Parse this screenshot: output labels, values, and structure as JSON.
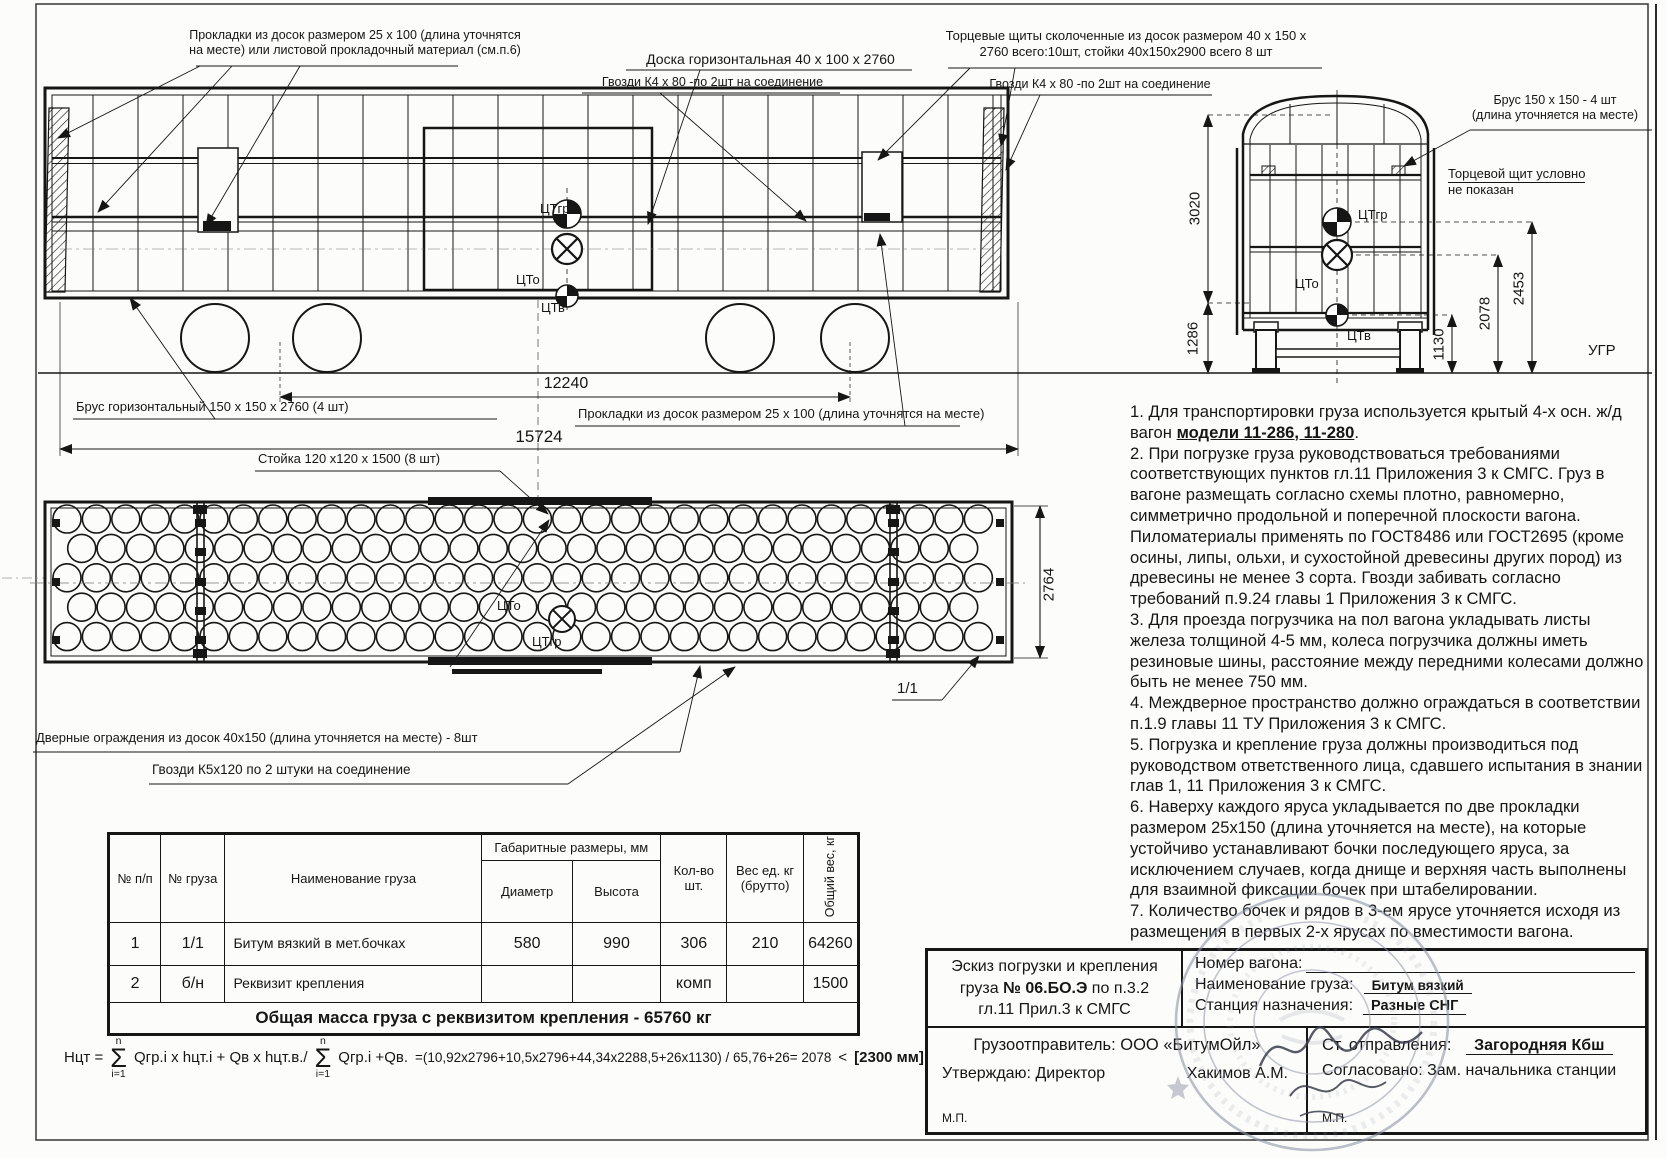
{
  "colors": {
    "paper": "#fcfcfb",
    "ink": "#161616",
    "stamp": "#8d94a6"
  },
  "callouts": {
    "gaskets_top": "Прокладки из досок размером 25 x 100 (длина уточнятся на месте) или листовой прокладочный материал (см.п.6)",
    "board_horizontal": "Доска горизонтальная 40 x 100 x 2760",
    "nails_k4": "Гвозди К4 х 80 -по 2шт на соединение",
    "end_shields": "Торцевые щиты сколоченные из досок размером 40 x 150 x 2760 всего:10шт, стойки 40х150х2900 всего 8 шт",
    "brus_horizontal": "Брус горизонтальный 150 x 150 x 2760 (4 шт)",
    "gaskets_bottom": "Прокладки из досок размером 25 x 100 (длина уточнятся на месте)",
    "stoika": "Стойка 120 х120 х 1500 (8 шт)",
    "door_guards": "Дверные ограждения из досок 40х150 (длина уточняется на месте) - 8шт",
    "nails_k5": "Гвозди К5х120 по 2 штуки на соединение",
    "brus_end_l1": "Брус 150 x 150 - 4 шт",
    "brus_end_l2": "(длина уточняется на месте)",
    "end_shield_note_l1": "Торцевой щит условно",
    "end_shield_note_l2": "не показан",
    "item_mark": "1/1"
  },
  "dimensions": {
    "wheel_base": "12240",
    "overall_length": "15724",
    "inner_height": "3020",
    "floor_height": "1286",
    "cg_wagon_height": "1130",
    "cg_combined_height": "2078",
    "cg_cargo_height": "2453",
    "inner_width": "2764",
    "rail_level": "УГР"
  },
  "cg": {
    "cargo": "ЦТгр",
    "combined": "ЦТо",
    "wagon": "ЦТв"
  },
  "notes": {
    "n1_pre": "1. Для транспортировки груза используется крытый 4-х осн. ж/д вагон ",
    "n1_model": "модели 11-286, 11-280",
    "n1_post": ".",
    "n2": "2. При погрузке груза руководствоваться требованиями соответствующих пунктов гл.11 Приложения 3 к СМГС.  Груз в вагоне размещать согласно схемы плотно, равномерно, симметрично продольной и поперечной плоскости вагона. Пиломатериалы применять по ГОСТ8486 или ГОСТ2695 (кроме осины, липы, ольхи, и сухостойной древесины других пород) из древесины не менее 3 сорта. Гвозди забивать согласно требований п.9.24  главы 1 Приложения 3 к СМГС.",
    "n3": "3. Для проезда погрузчика на пол вагона укладывать листы железа толщиной 4-5 мм, колеса погрузчика должны иметь резиновые шины, расстояние между передними колесами должно быть не менее 750  мм.",
    "n4": "4. Междверное пространство должно ограждаться в соответствии п.1.9 главы 11 ТУ Приложения 3 к СМГС.",
    "n5": "5. Погрузка и крепление груза должны производиться под руководством ответственного лица, сдавшего испытания в знании глав 1, 11 Приложения 3 к СМГС.",
    "n6": "6. Наверху каждого яруса укладывается по две прокладки размером 25х150 (длина уточняется на месте), на которые устойчиво устанавливают бочки последующего яруса, за исключением случаев, когда днище и верхняя часть выполнены для взаимной фиксации бочек при штабелировании.",
    "n7": "7. Количество бочек и рядов в 3-ем ярусе уточняется исходя из размещения в первых 2-х ярусах по вместимости вагона."
  },
  "table": {
    "col_num": "№ п/п",
    "col_cargo_num": "№ груза",
    "col_name": "Наименование груза",
    "col_size_group": "Габаритные размеры, мм",
    "col_diameter": "Диаметр",
    "col_height": "Высота",
    "col_qty": "Кол-во шт.",
    "col_unit_weight": "Вес ед. кг (брутто)",
    "col_total_weight": "Общий вес, кг",
    "rows": [
      [
        "1",
        "1/1",
        "Битум вязкий в мет.бочках",
        "580",
        "990",
        "306",
        "210",
        "64260"
      ],
      [
        "2",
        "б/н",
        "Реквизит крепления",
        "",
        "",
        "комп",
        "",
        "1500"
      ]
    ],
    "total": "Общая масса груза с реквизитом крепления -   65760 кг"
  },
  "formula": {
    "lhs": "Нцт =",
    "sum_sup": "n",
    "sum_sub": "i=1",
    "term1": "Qгр.i  x  hцт.i + Qв x  hцт.в./",
    "term2": "Qгр.i +Qв.",
    "calc": "=(10,92x2796+10,5x2796+44,34x2288,5+26x1130) / 65,76+26= 2078",
    "less": "<",
    "limit": "[2300 мм]"
  },
  "title_block": {
    "sketch_l1": "Эскиз погрузки и крепления",
    "sketch_l2_pre": "груза ",
    "sketch_no": "№ 06.БО.Э",
    "sketch_l2_post": " по п.3.2",
    "sketch_l3": "гл.11 Прил.3 к СМГС",
    "wagon_no_label": "Номер вагона:",
    "cargo_label": "Наименование груза:",
    "cargo_value": "Битум вязкий",
    "station_label": "Станция назначения:",
    "station_value": "Разные СНГ",
    "shipper": "Грузоотправитель: ООО «БитумОйл»",
    "approve": "Утверждаю:   Директор",
    "approver": "Хакимов А.М.",
    "mp": "М.П.",
    "departure_label": "Ст. отправления:",
    "departure_value": "Загородняя  Кбш",
    "agreed": "Согласовано: Зам. начальника станции"
  }
}
